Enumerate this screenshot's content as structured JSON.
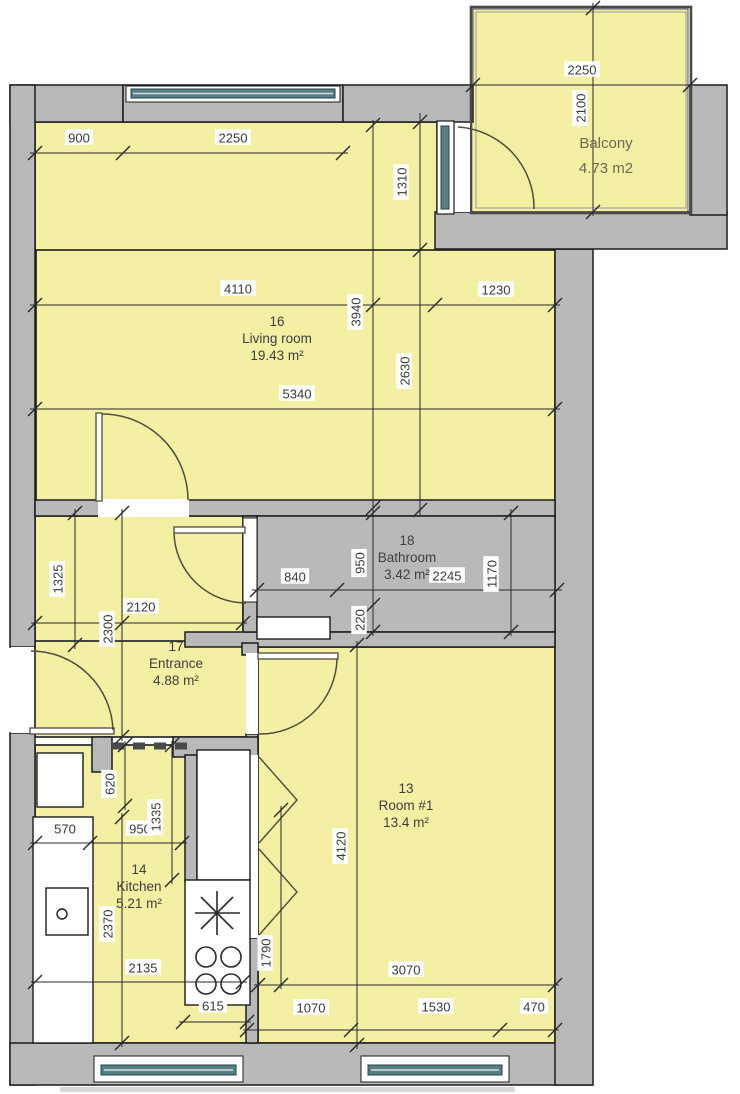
{
  "plan": {
    "rooms": [
      {
        "number": "16",
        "name": "Living room",
        "area": "19.43 m²",
        "cx": 277,
        "cy": 338
      },
      {
        "number": "18",
        "name": "Bathroom",
        "area": "3.42 m²",
        "cx": 407,
        "cy": 557
      },
      {
        "number": "17",
        "name": "Entrance",
        "area": "4.88 m²",
        "cx": 176,
        "cy": 663
      },
      {
        "number": "13",
        "name": "Room #1",
        "area": "13.4 m²",
        "cx": 406,
        "cy": 805
      },
      {
        "number": "14",
        "name": "Kitchen",
        "area": "5.21 m²",
        "cx": 139,
        "cy": 886
      },
      {
        "number": "",
        "name": "Balcony",
        "area": "4.73 m2",
        "cx": 606,
        "cy": 143
      }
    ],
    "dimensions": [
      {
        "text": "900",
        "x": 79,
        "y": 138,
        "rot": false
      },
      {
        "text": "2250",
        "x": 233,
        "y": 138,
        "rot": false
      },
      {
        "text": "4110",
        "x": 238,
        "y": 289,
        "rot": false
      },
      {
        "text": "1230",
        "x": 496,
        "y": 290,
        "rot": false
      },
      {
        "text": "3940",
        "x": 356,
        "y": 312,
        "rot": true
      },
      {
        "text": "2630",
        "x": 405,
        "y": 371,
        "rot": true
      },
      {
        "text": "1310",
        "x": 402,
        "y": 182,
        "rot": true
      },
      {
        "text": "5340",
        "x": 297,
        "y": 394,
        "rot": false
      },
      {
        "text": "2250",
        "x": 582,
        "y": 70,
        "rot": false
      },
      {
        "text": "2100",
        "x": 581,
        "y": 108,
        "rot": true
      },
      {
        "text": "840",
        "x": 295,
        "y": 577,
        "rot": false
      },
      {
        "text": "950",
        "x": 360,
        "y": 563,
        "rot": true
      },
      {
        "text": "2245",
        "x": 447,
        "y": 576,
        "rot": false
      },
      {
        "text": "1170",
        "x": 492,
        "y": 574,
        "rot": true
      },
      {
        "text": "220",
        "x": 360,
        "y": 620,
        "rot": true
      },
      {
        "text": "1325",
        "x": 58,
        "y": 579,
        "rot": true
      },
      {
        "text": "2120",
        "x": 141,
        "y": 607,
        "rot": false
      },
      {
        "text": "2300",
        "x": 108,
        "y": 629,
        "rot": true
      },
      {
        "text": "570",
        "x": 65,
        "y": 829,
        "rot": false
      },
      {
        "text": "620",
        "x": 110,
        "y": 784,
        "rot": true
      },
      {
        "text": "950",
        "x": 140,
        "y": 829,
        "rot": false
      },
      {
        "text": "1335",
        "x": 156,
        "y": 817,
        "rot": true
      },
      {
        "text": "2370",
        "x": 108,
        "y": 924,
        "rot": true
      },
      {
        "text": "2135",
        "x": 143,
        "y": 968,
        "rot": false
      },
      {
        "text": "615",
        "x": 213,
        "y": 1006,
        "rot": false
      },
      {
        "text": "1790",
        "x": 266,
        "y": 953,
        "rot": true
      },
      {
        "text": "4120",
        "x": 341,
        "y": 846,
        "rot": true
      },
      {
        "text": "3070",
        "x": 406,
        "y": 970,
        "rot": false
      },
      {
        "text": "1070",
        "x": 311,
        "y": 1008,
        "rot": false
      },
      {
        "text": "1530",
        "x": 436,
        "y": 1007,
        "rot": false
      },
      {
        "text": "470",
        "x": 534,
        "y": 1007,
        "rot": false
      }
    ],
    "colors": {
      "room_fill": "#f3efa3",
      "wall_fill": "#b9b9b9",
      "outline": "#1c1c1c",
      "window_glass": "#577f84",
      "dim_line": "#2a2a2a",
      "balcony_text": "#6a6a52"
    }
  }
}
